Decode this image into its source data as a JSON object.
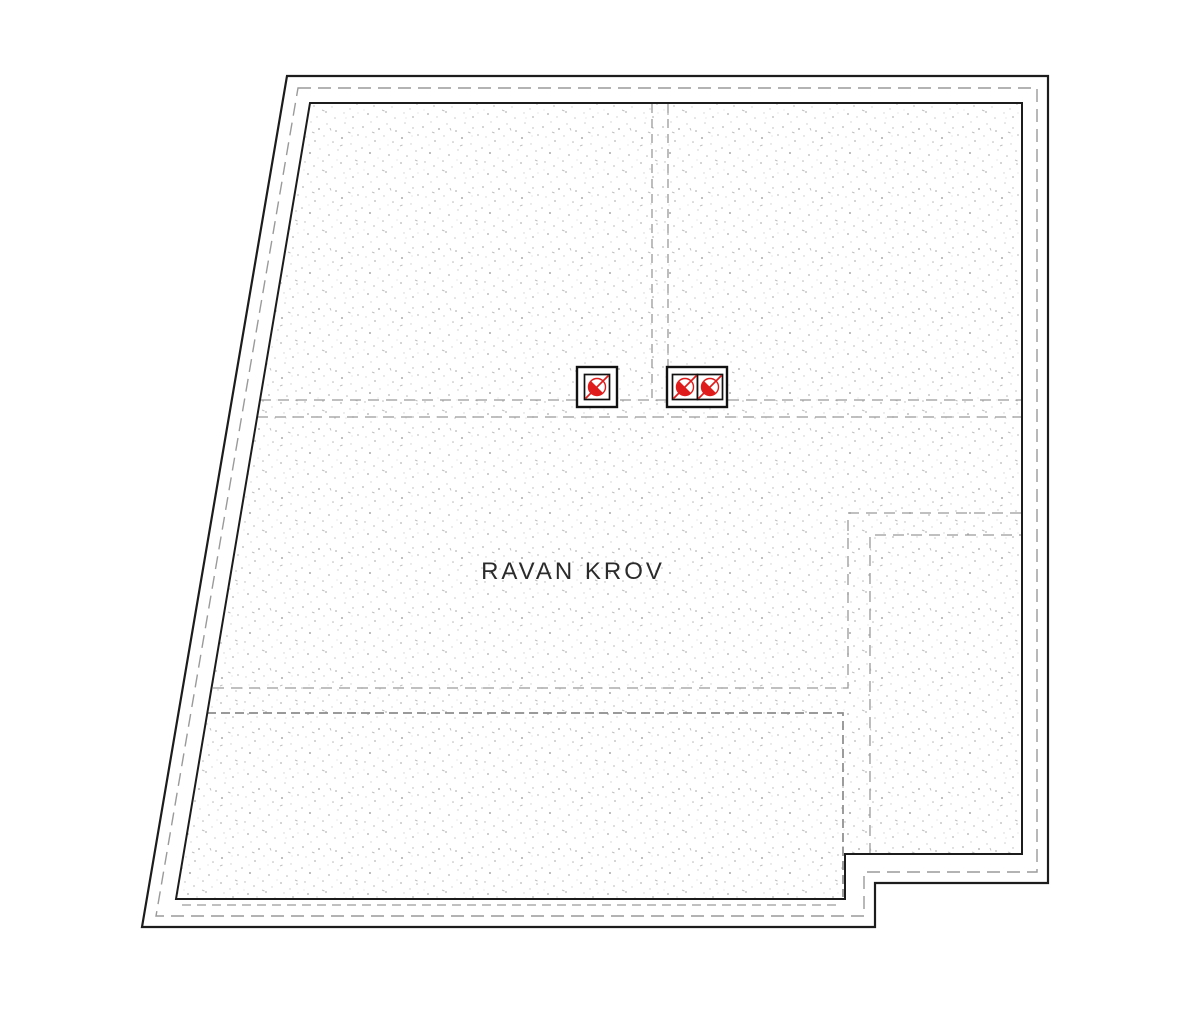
{
  "plan": {
    "title": "RAVAN KROV",
    "drawing_type": "flat-roof-plan",
    "colors": {
      "line": "#1c1c1c",
      "hidden_line": "#9a9a9a",
      "vent_red": "#e01b1b",
      "stipple": "#b4b4b4",
      "paper": "#ffffff"
    },
    "vent_groups": [
      {
        "type": "single-box",
        "circles": 1
      },
      {
        "type": "double-box",
        "circles": 2
      }
    ],
    "vent_symbol": "slashed-circle",
    "vent_symbol_count": 3
  }
}
